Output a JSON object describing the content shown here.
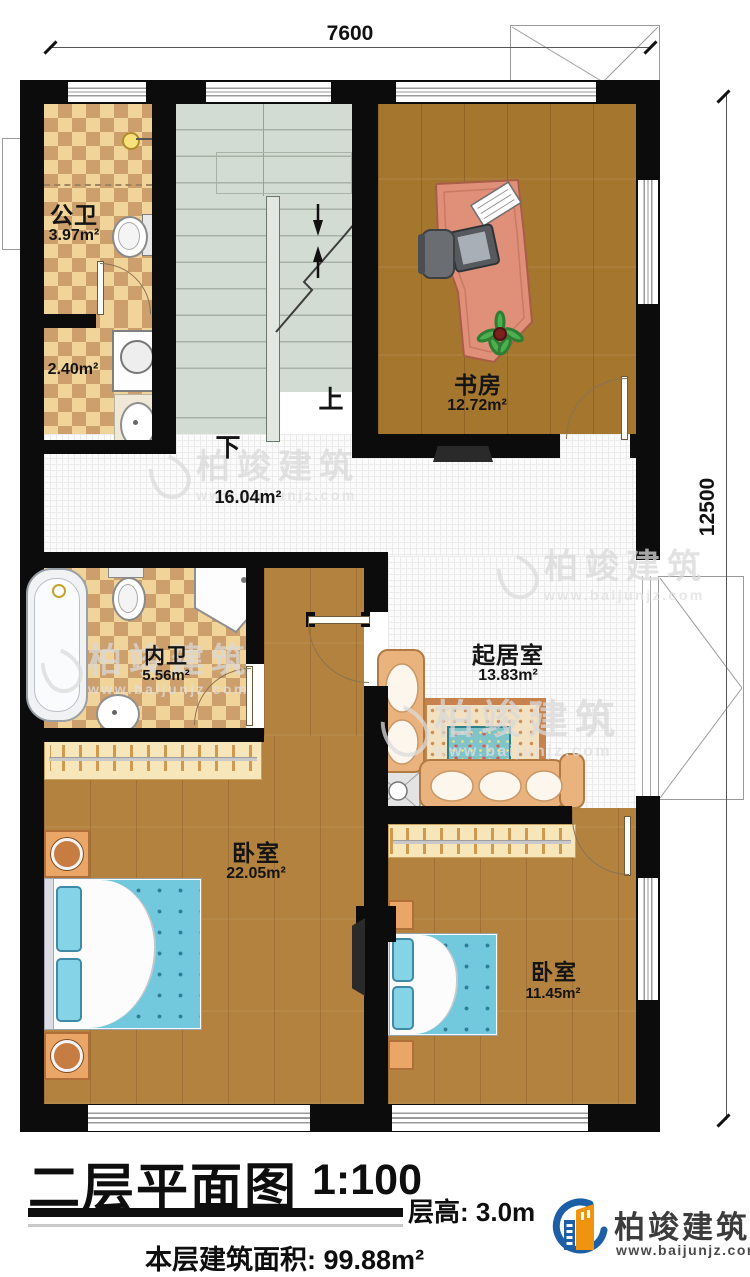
{
  "dimensions": {
    "top": "7600",
    "right": "12500"
  },
  "stairs": {
    "up": "上",
    "down": "下"
  },
  "rooms": {
    "gongwei": {
      "name": "公卫",
      "area": "3.97m²"
    },
    "laundry": {
      "area": "2.40m²"
    },
    "shufang": {
      "name": "书房",
      "area": "12.72m²"
    },
    "corridor": {
      "area": "16.04m²"
    },
    "neiwei": {
      "name": "内卫",
      "area": "5.56m²"
    },
    "qijushi": {
      "name": "起居室",
      "area": "13.83m²"
    },
    "bedroom_master": {
      "name": "卧室",
      "area": "22.05m²"
    },
    "bedroom_second": {
      "name": "卧室",
      "area": "11.45m²"
    }
  },
  "title_block": {
    "title": "二层平面图",
    "scale": "1:100",
    "floor_height": "层高: 3.0m",
    "floor_area": "本层建筑面积: 99.88m²"
  },
  "brand": {
    "name": "柏竣建筑",
    "website": "www.baijunjz.com"
  },
  "watermark": {
    "name": "柏竣建筑",
    "website": "www.baijunjz.com"
  },
  "colors": {
    "wall": "#0c0c0c",
    "brand_blue": "#1d5fa7",
    "brand_orange": "#f0930f"
  }
}
